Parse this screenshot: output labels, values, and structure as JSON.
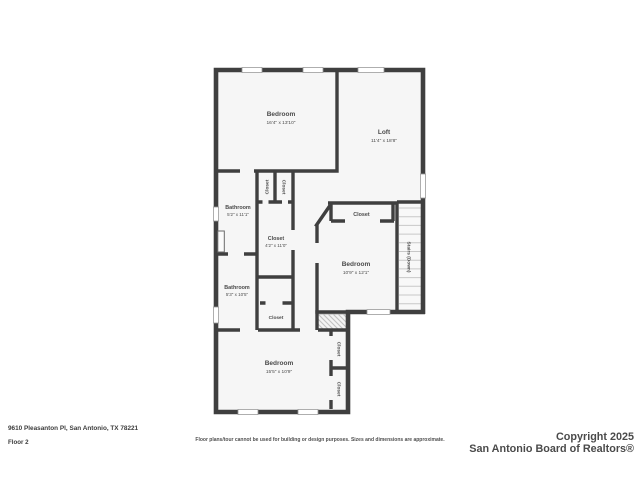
{
  "meta": {
    "address": "9610 Pleasanton Pl, San Antonio, TX 78221",
    "floor_label": "Floor 2",
    "disclaimer": "Floor plans/tour cannot be used for building or design purposes. Sizes and dimensions are approximate.",
    "copyright_line1": "Copyright 2025",
    "copyright_line2": "San Antonio Board of Realtors®"
  },
  "colors": {
    "wall": "#3f3f3f",
    "room_fill": "#f6f6f6",
    "label_text": "#4a4a4a",
    "stair_tread": "#c8c8c8",
    "window_line": "#9a9a9a",
    "background": "#ffffff"
  },
  "rooms": {
    "bedroom_top": {
      "name": "Bedroom",
      "dims": "16'4\" x 13'10\""
    },
    "loft": {
      "name": "Loft",
      "dims": "11'4\" x 18'8\""
    },
    "bathroom_upper": {
      "name": "Bathroom",
      "dims": "5'2\" x 11'1\""
    },
    "closet_center": {
      "name": "Closet",
      "dims": "4'2\" x 11'0\""
    },
    "bathroom_lower": {
      "name": "Bathroom",
      "dims": "5'3\" x 10'5\""
    },
    "bedroom_middle": {
      "name": "Bedroom",
      "dims": "10'9\" x 12'1\""
    },
    "bedroom_bottom": {
      "name": "Bedroom",
      "dims": "15'5\" x 10'9\""
    },
    "closet_small_left": {
      "name": "Closet"
    },
    "closet_small_right": {
      "name": "Closet"
    },
    "closet_mid_bedroom": {
      "name": "Closet"
    },
    "closet_hall": {
      "name": "Closet"
    },
    "closet_bottom_upper": {
      "name": "Closet"
    },
    "closet_bottom_lower": {
      "name": "Closet"
    },
    "stairs": {
      "name": "Stairs (Down)"
    }
  }
}
